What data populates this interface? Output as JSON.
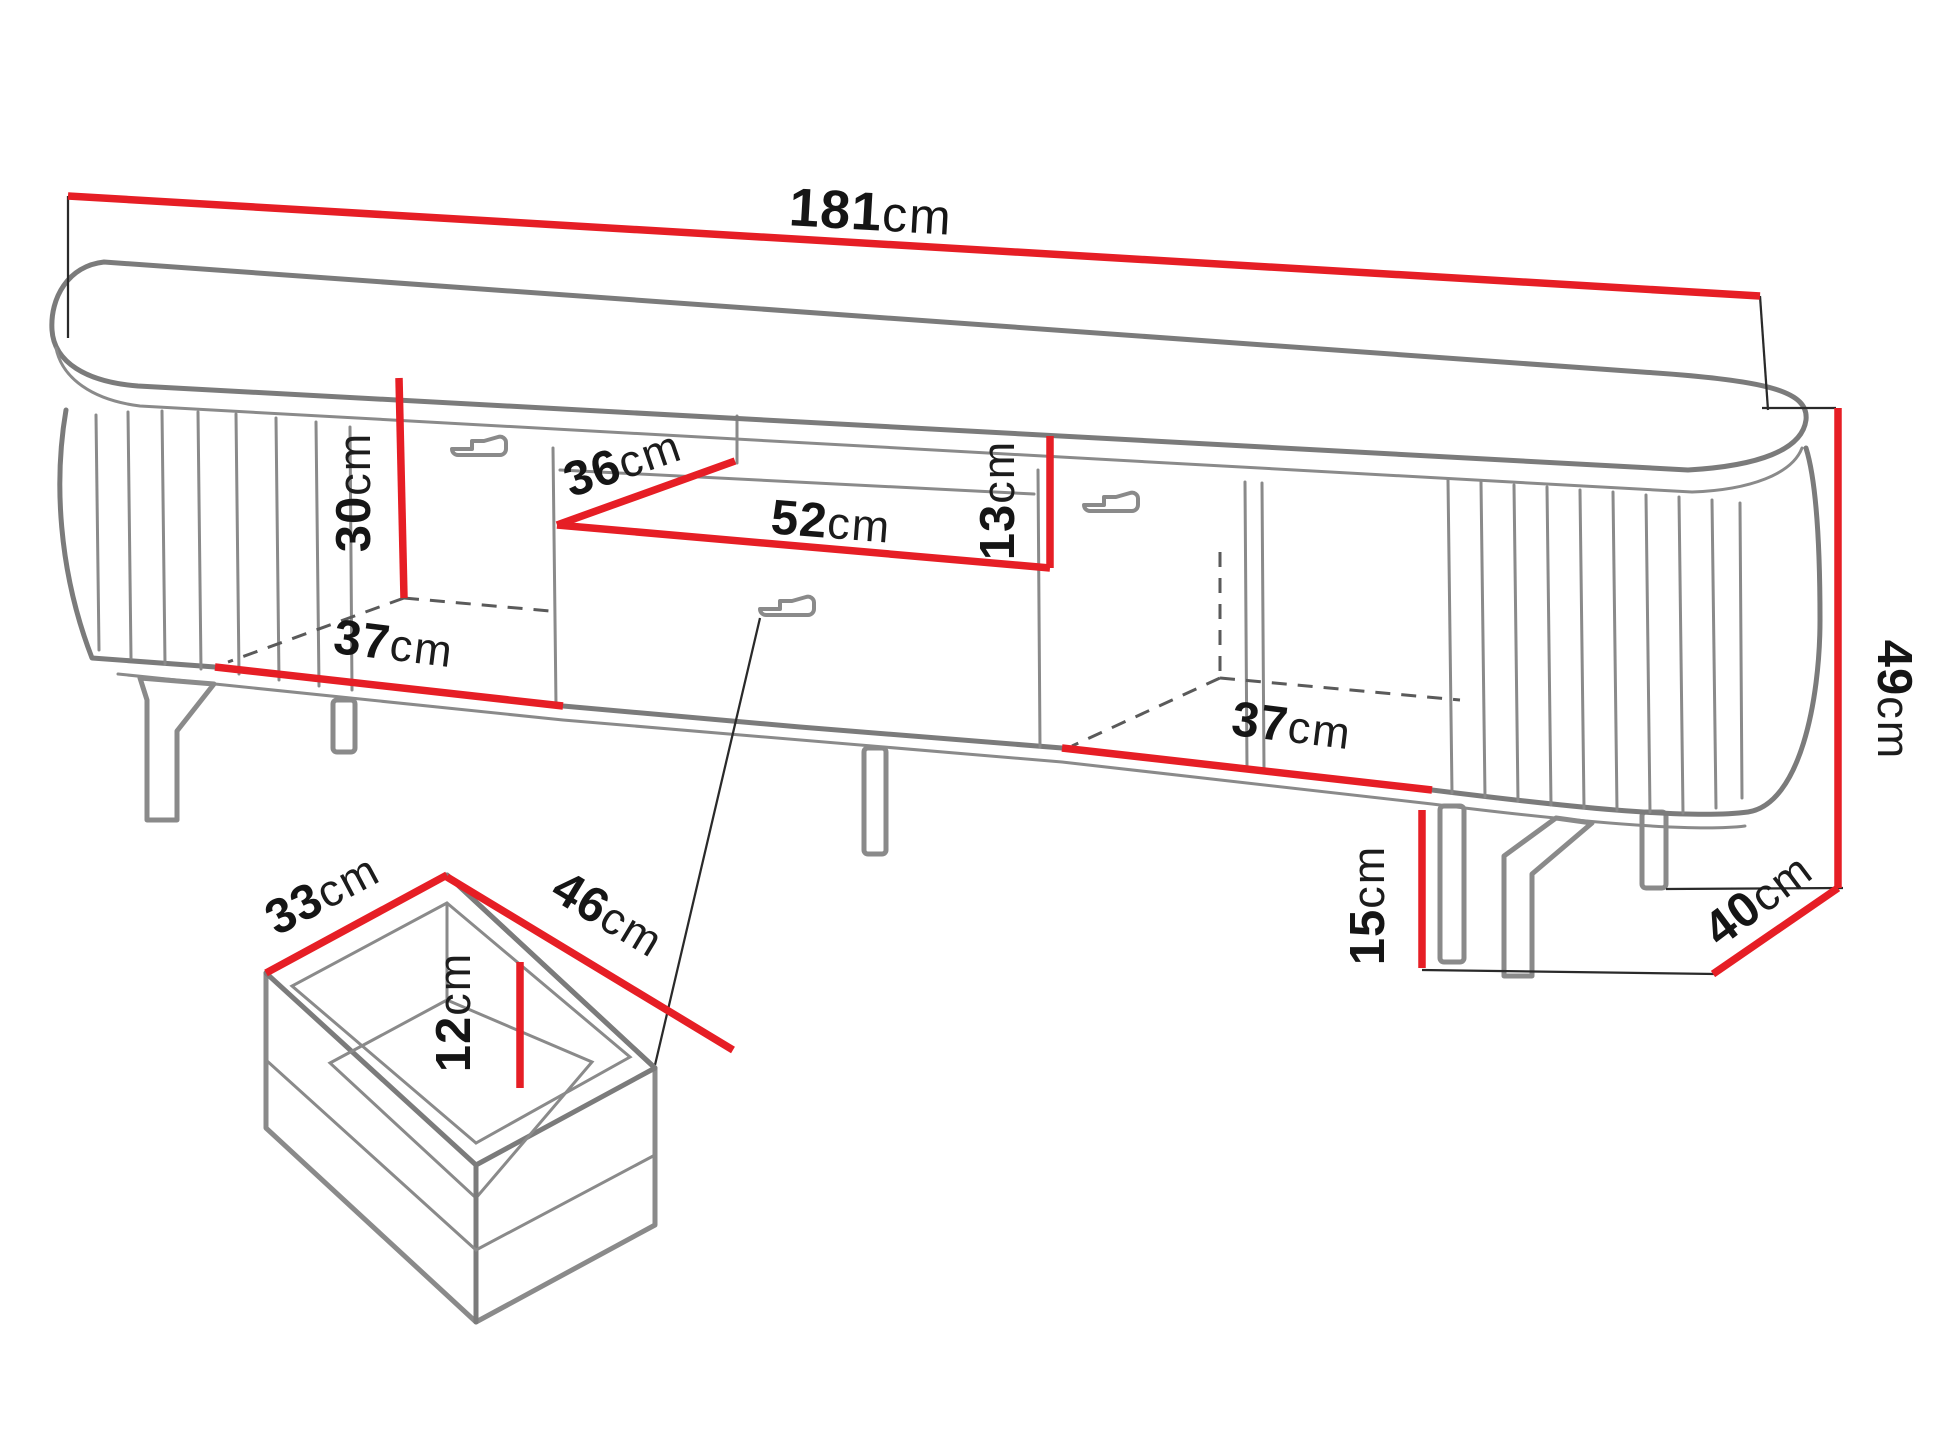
{
  "title": "TV stand dimension diagram",
  "dims": {
    "width": {
      "value": "181",
      "unit": "cm"
    },
    "left_inner_height": {
      "value": "30",
      "unit": "cm"
    },
    "niche_depth": {
      "value": "36",
      "unit": "cm"
    },
    "niche_width": {
      "value": "52",
      "unit": "cm"
    },
    "niche_height": {
      "value": "13",
      "unit": "cm"
    },
    "left_inner_width": {
      "value": "37",
      "unit": "cm"
    },
    "right_inner_width": {
      "value": "37",
      "unit": "cm"
    },
    "total_height": {
      "value": "49",
      "unit": "cm"
    },
    "depth": {
      "value": "40",
      "unit": "cm"
    },
    "leg_height": {
      "value": "15",
      "unit": "cm"
    },
    "drawer_depth": {
      "value": "33",
      "unit": "cm"
    },
    "drawer_width": {
      "value": "46",
      "unit": "cm"
    },
    "drawer_height": {
      "value": "12",
      "unit": "cm"
    }
  },
  "colors": {
    "dimension_line": "#e61e25",
    "furniture_outline": "#7b7b7b",
    "label_text": "#151515"
  }
}
